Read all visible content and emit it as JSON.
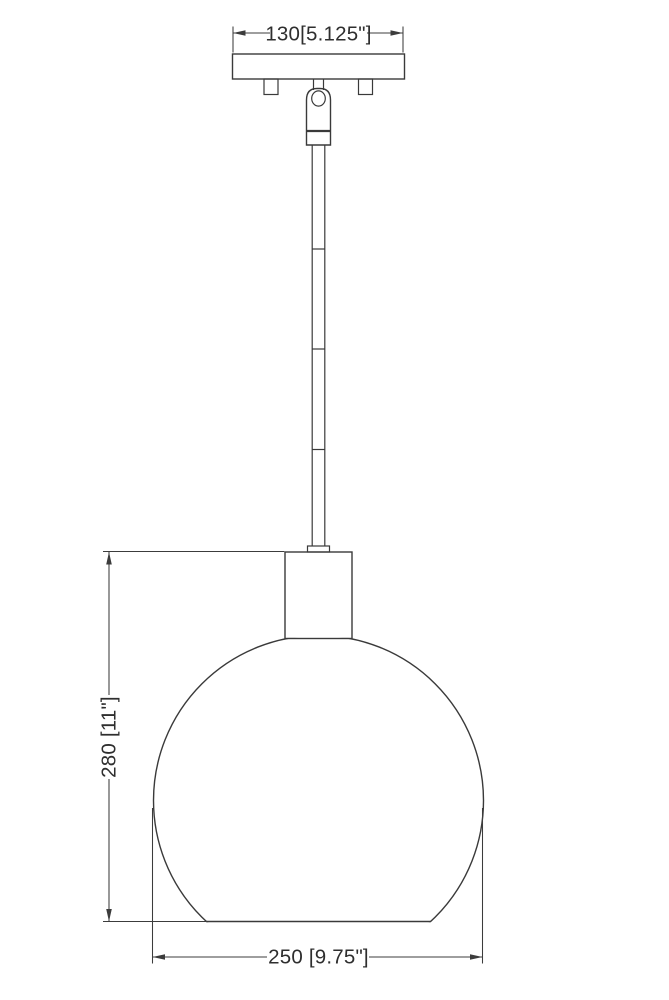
{
  "page": {
    "background": "#ffffff",
    "line_color": "#3a3a3a"
  },
  "drawing": {
    "type": "pendant-light-fixture-dimension-drawing",
    "parts": [
      "ceiling-canopy",
      "mounting-screw-left",
      "mounting-screw-right",
      "swivel-joint",
      "stem-rod",
      "stem-couplings",
      "socket-holder",
      "globe-shade"
    ],
    "dimensions": {
      "canopy_width": {
        "label": "130[5.125\"]",
        "mm": 130,
        "inches": "5.125\""
      },
      "overall_height": {
        "label": "280 [11\"]",
        "mm": 280,
        "inches": "11\""
      },
      "shade_diameter": {
        "label": "250 [9.75\"]",
        "mm": 250,
        "inches": "9.75\""
      }
    }
  }
}
